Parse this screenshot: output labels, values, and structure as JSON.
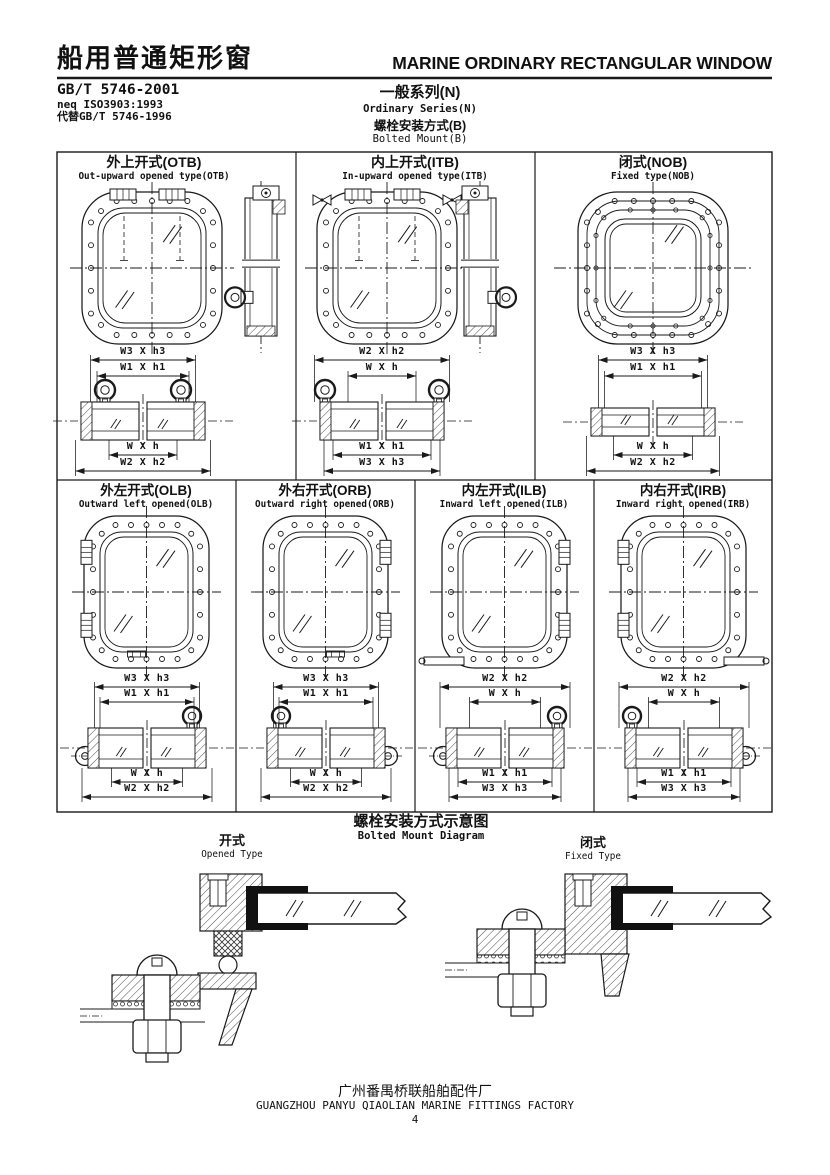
{
  "header": {
    "title_cn": "船用普通矩形窗",
    "title_en": "MARINE ORDINARY RECTANGULAR WINDOW",
    "standard": "GB/T 5746-2001",
    "standard_neq": "neq ISO3903:1993",
    "standard_replaces": "代替GB/T 5746-1996",
    "series_cn": "一般系列(N)",
    "series_en": "Ordinary Series(N)",
    "mount_cn": "螺栓安装方式(B)",
    "mount_en": "Bolted Mount(B)"
  },
  "panels": [
    {
      "code": "OTB",
      "title_cn": "外上开式(OTB)",
      "title_en": "Out-upward opened type(OTB)",
      "dims_top": [
        "W3 X h3",
        "W1 X h1"
      ],
      "dims_bottom": [
        "W X h",
        "W2 X h2"
      ]
    },
    {
      "code": "ITB",
      "title_cn": "内上开式(ITB)",
      "title_en": "In-upward opened type(ITB)",
      "dims_top": [
        "W2 X h2",
        "W X h"
      ],
      "dims_bottom": [
        "W1 X h1",
        "W3 X h3"
      ]
    },
    {
      "code": "NOB",
      "title_cn": "闭式(NOB)",
      "title_en": "Fixed type(NOB)",
      "dims_top": [
        "W3 X h3",
        "W1 X h1"
      ],
      "dims_bottom": [
        "W X h",
        "W2 X h2"
      ]
    },
    {
      "code": "OLB",
      "title_cn": "外左开式(OLB)",
      "title_en": "Outward left opened(OLB)",
      "dims_top": [
        "W3 X h3",
        "W1 X h1"
      ],
      "dims_bottom": [
        "W X h",
        "W2 X h2"
      ]
    },
    {
      "code": "ORB",
      "title_cn": "外右开式(ORB)",
      "title_en": "Outward right opened(ORB)",
      "dims_top": [
        "W3 X h3",
        "W1 X h1"
      ],
      "dims_bottom": [
        "W X h",
        "W2 X h2"
      ]
    },
    {
      "code": "ILB",
      "title_cn": "内左开式(ILB)",
      "title_en": "Inward left opened(ILB)",
      "dims_top": [
        "W2 X h2",
        "W X h"
      ],
      "dims_bottom": [
        "W1 X h1",
        "W3 X h3"
      ]
    },
    {
      "code": "IRB",
      "title_cn": "内右开式(IRB)",
      "title_en": "Inward right opened(IRB)",
      "dims_top": [
        "W2 X h2",
        "W X h"
      ],
      "dims_bottom": [
        "W1 X h1",
        "W3 X h3"
      ]
    }
  ],
  "mount_diagram": {
    "title_cn": "螺栓安装方式示意图",
    "title_en": "Bolted Mount Diagram",
    "opened_cn": "开式",
    "opened_en": "Opened Type",
    "fixed_cn": "闭式",
    "fixed_en": "Fixed Type"
  },
  "footer": {
    "factory_cn": "广州番禺桥联船舶配件厂",
    "factory_en": "GUANGZHOU PANYU QIAOLIAN MARINE FITTINGS FACTORY",
    "page": "4"
  }
}
